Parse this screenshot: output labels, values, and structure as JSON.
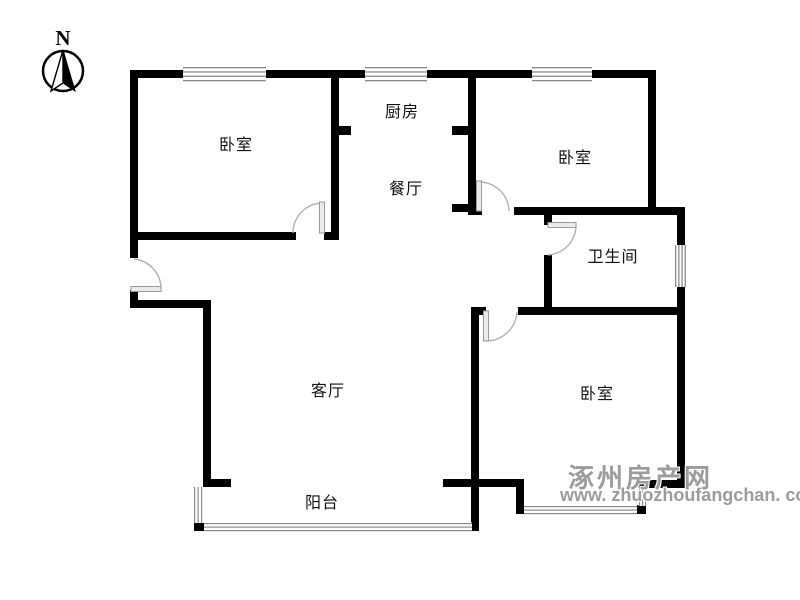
{
  "meta": {
    "width": 800,
    "height": 600,
    "background": "#ffffff"
  },
  "compass": {
    "label": "N"
  },
  "rooms": [
    {
      "id": "bedroom-top-left",
      "label": "卧室",
      "x": 236,
      "y": 143
    },
    {
      "id": "kitchen",
      "label": "厨房",
      "x": 402,
      "y": 110
    },
    {
      "id": "dining-room",
      "label": "餐厅",
      "x": 406,
      "y": 187
    },
    {
      "id": "bedroom-top-right",
      "label": "卧室",
      "x": 575,
      "y": 156
    },
    {
      "id": "bathroom",
      "label": "卫生间",
      "x": 613,
      "y": 255
    },
    {
      "id": "bedroom-bottom-right",
      "label": "卧室",
      "x": 597,
      "y": 392
    },
    {
      "id": "living-room",
      "label": "客厅",
      "x": 328,
      "y": 389
    },
    {
      "id": "balcony",
      "label": "阳台",
      "x": 322,
      "y": 501
    }
  ],
  "watermark": {
    "site_name": "涿州房产网",
    "site_url": "www. zhuozhoufangchan. com"
  },
  "colors": {
    "wall": "#000000",
    "window-line": "#8a8a8a",
    "door-arc": "#b3b3b3",
    "door-leaf-fill": "#ebebeb",
    "door-leaf-stroke": "#9a9a9a",
    "label": "#111111",
    "watermark": "#9c9c9c"
  }
}
